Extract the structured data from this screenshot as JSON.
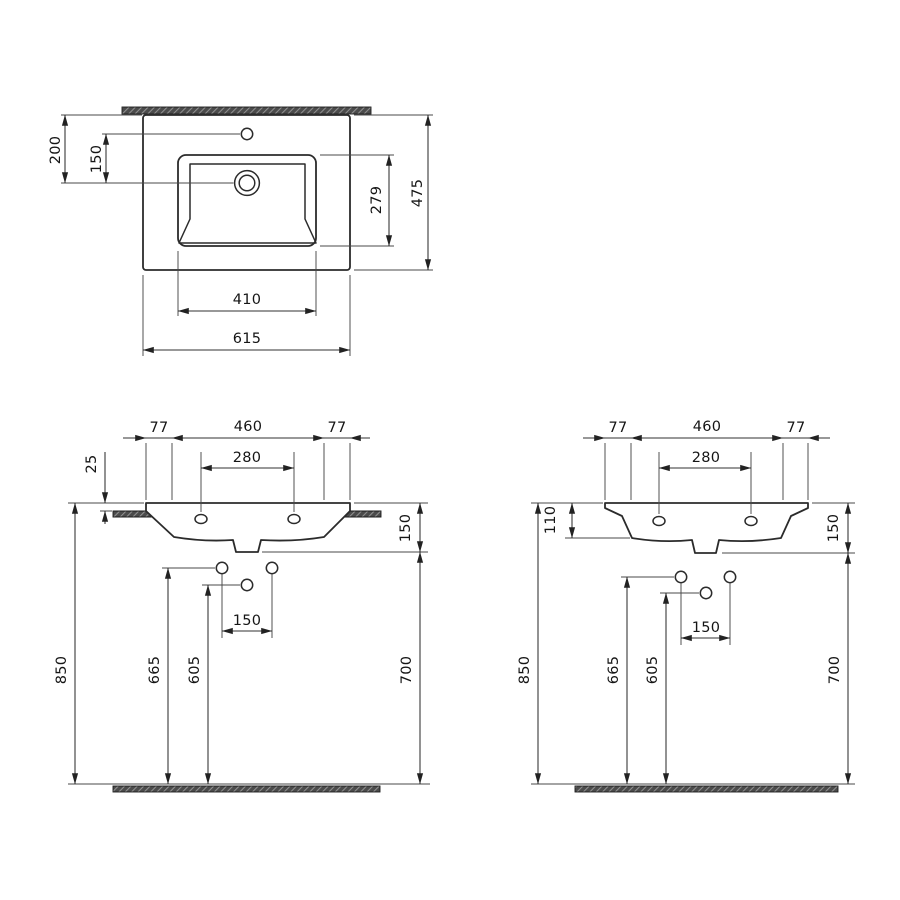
{
  "colors": {
    "background": "#ffffff",
    "line": "#2b2b2b",
    "dimension_line": "#303030",
    "hatch_fill": "#4b4b4b"
  },
  "views": {
    "plan": {
      "edge_to_drain": "200",
      "faucet_to_drain": "150",
      "basin_depth": "279",
      "overall_depth": "475",
      "basin_width": "410",
      "overall_width": "615"
    },
    "front_countertop": {
      "overhang_left": "77",
      "basin_span": "460",
      "overhang_right": "77",
      "faucet_hole_spacing": "280",
      "rim_above_counter": "25",
      "rim_to_outlet": "150",
      "supply_spacing": "150",
      "rim_height": "850",
      "supply_height": "665",
      "trap_height": "605",
      "outlet_line_height": "700"
    },
    "front_wall": {
      "overhang_left": "77",
      "basin_span": "460",
      "overhang_right": "77",
      "faucet_hole_spacing": "280",
      "body_height": "110",
      "rim_to_outlet": "150",
      "supply_spacing": "150",
      "rim_height": "850",
      "supply_height": "665",
      "trap_height": "605",
      "outlet_line_height": "700"
    }
  }
}
